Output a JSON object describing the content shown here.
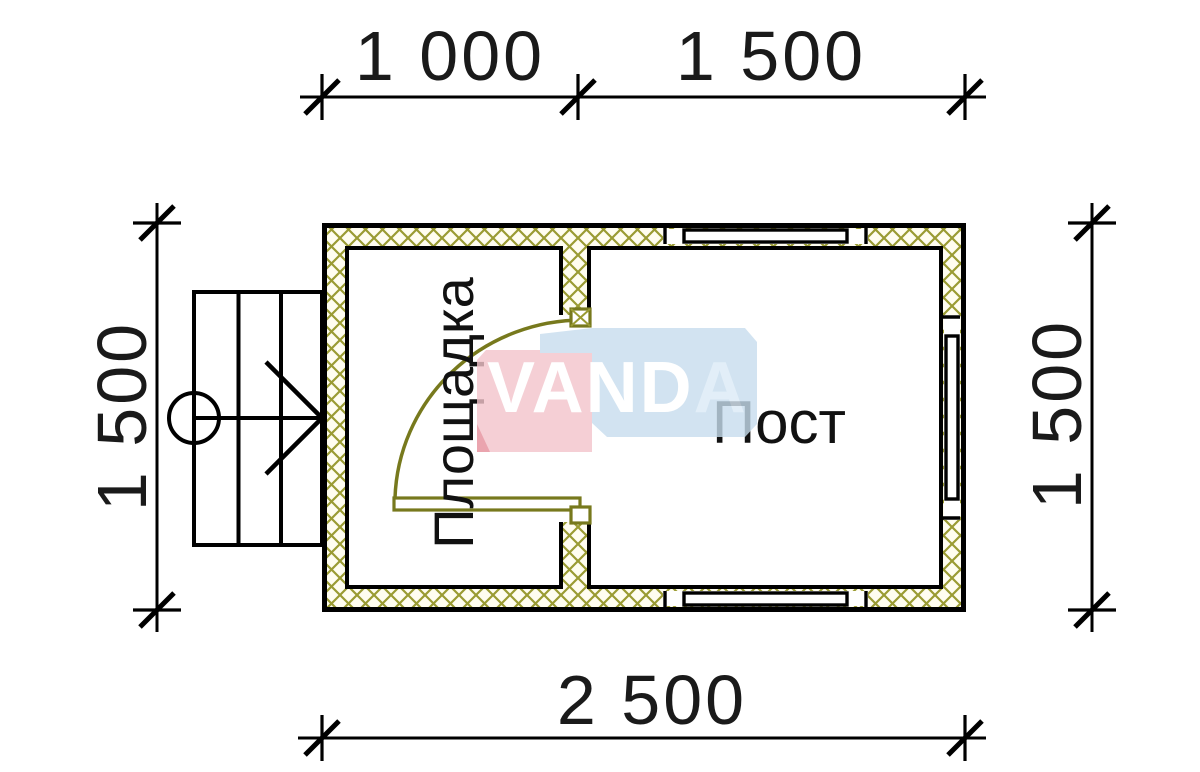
{
  "drawing": {
    "type": "architectural floor plan",
    "labels": {
      "left_room": "Площадка",
      "right_room": "Пост"
    },
    "dimensions": {
      "top_segment_left": "1 000",
      "top_segment_right": "1 500",
      "left_height": "1 500",
      "right_height": "1 500",
      "bottom_total": "2 500"
    },
    "watermark": {
      "brand_prefix": "VAND",
      "brand_suffix": "A",
      "blue": "#c7ddee",
      "pink": "#f3c4cb",
      "red_accent": "#e58e9b"
    },
    "colors": {
      "line_black": "#000000",
      "hatch_olive": "#9a9b33",
      "hatch_background": "#fffdf0",
      "door_olive": "#77791d"
    }
  }
}
